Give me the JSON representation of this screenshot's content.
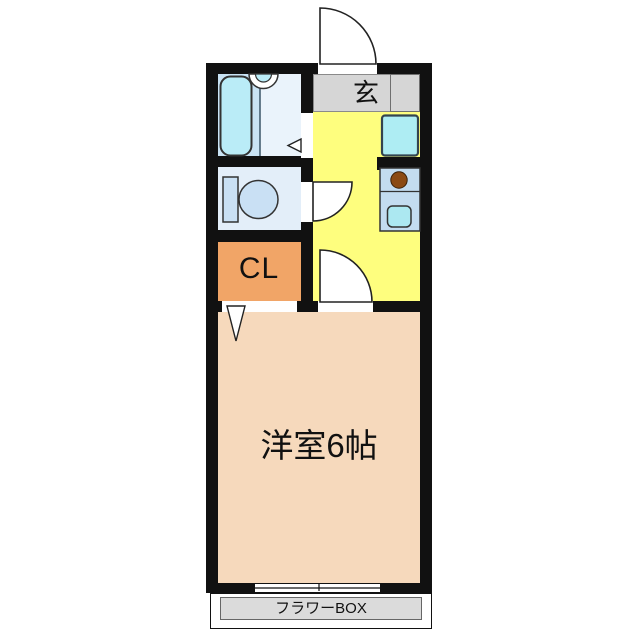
{
  "floorplan": {
    "labels": {
      "entrance": "玄",
      "closet": "CL",
      "main_room": "洋室6帖",
      "flower_box": "フラワーBOX"
    },
    "colors": {
      "wall_black": "#111111",
      "entrance_gray": "#D6D6D6",
      "kitchen_yellow": "#FEFE7E",
      "closet_orange": "#F1A567",
      "main_room_pink": "#F6D9BC",
      "bathroom_blue": "#C9E3F4",
      "bathroom_light_blue": "#EAF3FB",
      "bathtub_cyan": "#BAECF7",
      "toilet_room_blue": "#E3EEF9",
      "toilet_fixture_blue": "#C9E0F4",
      "washer_space_cyan": "#AEEDF3",
      "counter_blue": "#C3DCF0",
      "sink_cyan": "#ACE8F1",
      "stove_brown": "#8B4A14",
      "flower_box_gray": "#DBDBDB"
    }
  }
}
